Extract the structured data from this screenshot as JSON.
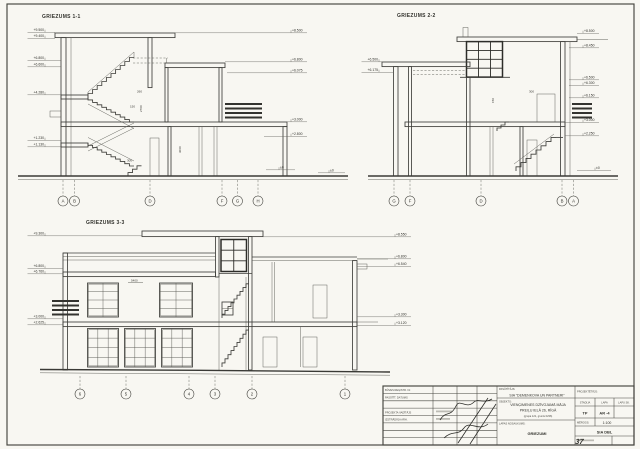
{
  "sections": {
    "s1": {
      "title": "GRIEZUMS 1-1",
      "bubbles": [
        "A",
        "B",
        "D",
        "F",
        "G",
        "H"
      ],
      "elev_left": [
        "+9.500",
        "+9.400",
        "+6.800",
        "+6.600",
        "+4.280",
        "+1.230",
        "+1.130"
      ],
      "elev_right": [
        "+8.500",
        "+6.800",
        "+6.075",
        "+3.000",
        "+2.800",
        "±0",
        "±0"
      ],
      "dims": [
        "260",
        "2700",
        "150",
        "300",
        "3060"
      ]
    },
    "s2": {
      "title": "GRIEZUMS 2-2",
      "bubbles": [
        "G",
        "F",
        "D",
        "B",
        "A"
      ],
      "elev_left": [
        "+6.500",
        "+6.175"
      ],
      "elev_right": [
        "+8.500",
        "+8.450",
        "+6.500",
        "+6.300",
        "+6.150",
        "+3.000",
        "+2.250",
        "±0"
      ],
      "dims": [
        "300",
        "150"
      ]
    },
    "s3": {
      "title": "GRIEZUMS 3-3",
      "bubbles": [
        "6",
        "5",
        "4",
        "3",
        "2",
        "1"
      ],
      "elev_left": [
        "+9.300",
        "+6.800",
        "+6.760",
        "+3.000",
        "+2.625"
      ],
      "elev_right": [
        "+8.550",
        "+6.800",
        "+6.540",
        "+3.300",
        "+3.120"
      ],
      "dims": [
        "5400"
      ]
    }
  },
  "title_block": {
    "reg_no_label": "BŪVES REĢISTR. Nr.",
    "order_date_label": "PASŪTĪT. DATUMS",
    "pm_label": "PROJEKTA VADĪTĀJS",
    "arch_label": "IZSTRĀDĀJA ARH.",
    "client_label": "PASŪTĪTĀJS:",
    "client": "SIA \"DEMENKOVA UN PARTNERI\"",
    "object_label": "OBJEKTS:",
    "object_line1": "VIENĢIMENES DZĪVOJAMĀ MĀJA",
    "object_line2": "PREIĻU IELĀ 26, RĪGĀ",
    "object_line3": "(grupa 121, grunts 0236)",
    "sheet_label": "LAPAS NOSAUKUMS:",
    "sheet_title": "GRIEZUMI",
    "designer_label": "PROJEKTĒTĀJS:",
    "stage_label": "STADIJA",
    "stage": "TP",
    "sheet_no_label": "LAPA",
    "sheet_no": "AR -4",
    "sheet_count_label": "LAPU SK.",
    "scale_label": "MĒROGS:",
    "scale": "1:100",
    "firm": "SIA DBL",
    "page_no": "37"
  }
}
